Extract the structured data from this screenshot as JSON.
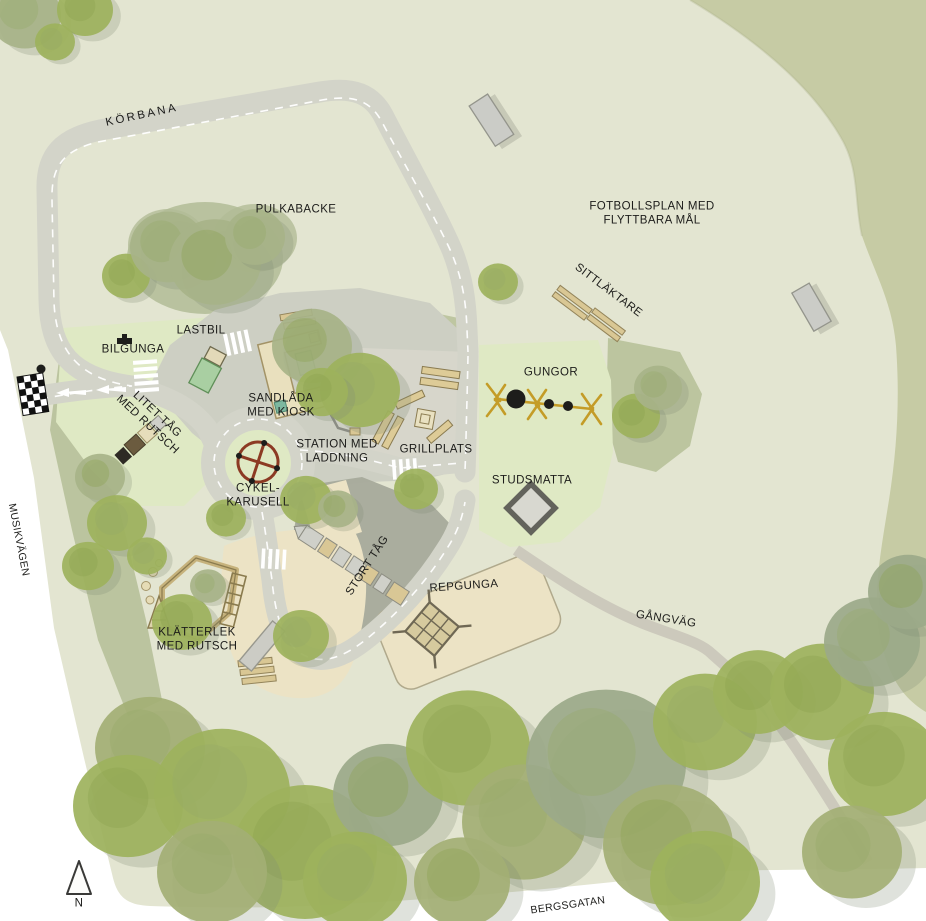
{
  "labels": {
    "korbana": "KÖRBANA",
    "pulkabacke": "PULKABACKE",
    "fotbollsplan": "FOTBOLLSPLAN MED\nFLYTTBARA MÅL",
    "sittlaktare": "SITTLÄKTARE",
    "lastbil": "LASTBIL",
    "bilgunga": "BILGUNGA",
    "sandlada": "SANDLÅDA\nMED KIOSK",
    "litet_tag": "LITET TÅG\nMED RUTSCH",
    "station": "STATION MED\nLADDNING",
    "grillplats": "GRILLPLATS",
    "gungor": "GUNGOR",
    "studsmatta": "STUDSMATTA",
    "cykelkarusell": "CYKEL-\nKARUSELL",
    "stort_tag": "STORT TÅG",
    "repgunga": "REPGUNGA",
    "klatterlek": "KLÄTTERLEK\nMED RUTSCH",
    "gangvag": "GÅNGVÄG",
    "musikvagen": "MUSIKVÄGEN",
    "bergsgatan": "BERGSGATAN",
    "compass_n": "N"
  },
  "icons": {
    "compass": "north-arrow-triangle",
    "start_flag": "checkered-flag",
    "carousel": "circle-with-cross",
    "swing_set": "yellow-frame-with-tires",
    "trampoline": "gray-diamond",
    "goal": "gray-rectangle",
    "rope_swing": "net-pyramid"
  },
  "colors": {
    "map_bg": "#e3e5d1",
    "forest_band": "#c6cba4",
    "olive_patch": "#b5bf97",
    "play_green": "#dfe9c4",
    "road": "#d3d4c9",
    "plaza": "#cdcfc3",
    "asphalt_dark": "#a6aa9b",
    "sand": "#ece3c5",
    "wood": "#d9c794",
    "carousel_red": "#8c3a23",
    "swing_yellow": "#c49c27",
    "tree_green": "#9db25c",
    "tree_olive": "#a7b388",
    "marking_white": "#ffffff",
    "text": "#1c1c1a"
  }
}
